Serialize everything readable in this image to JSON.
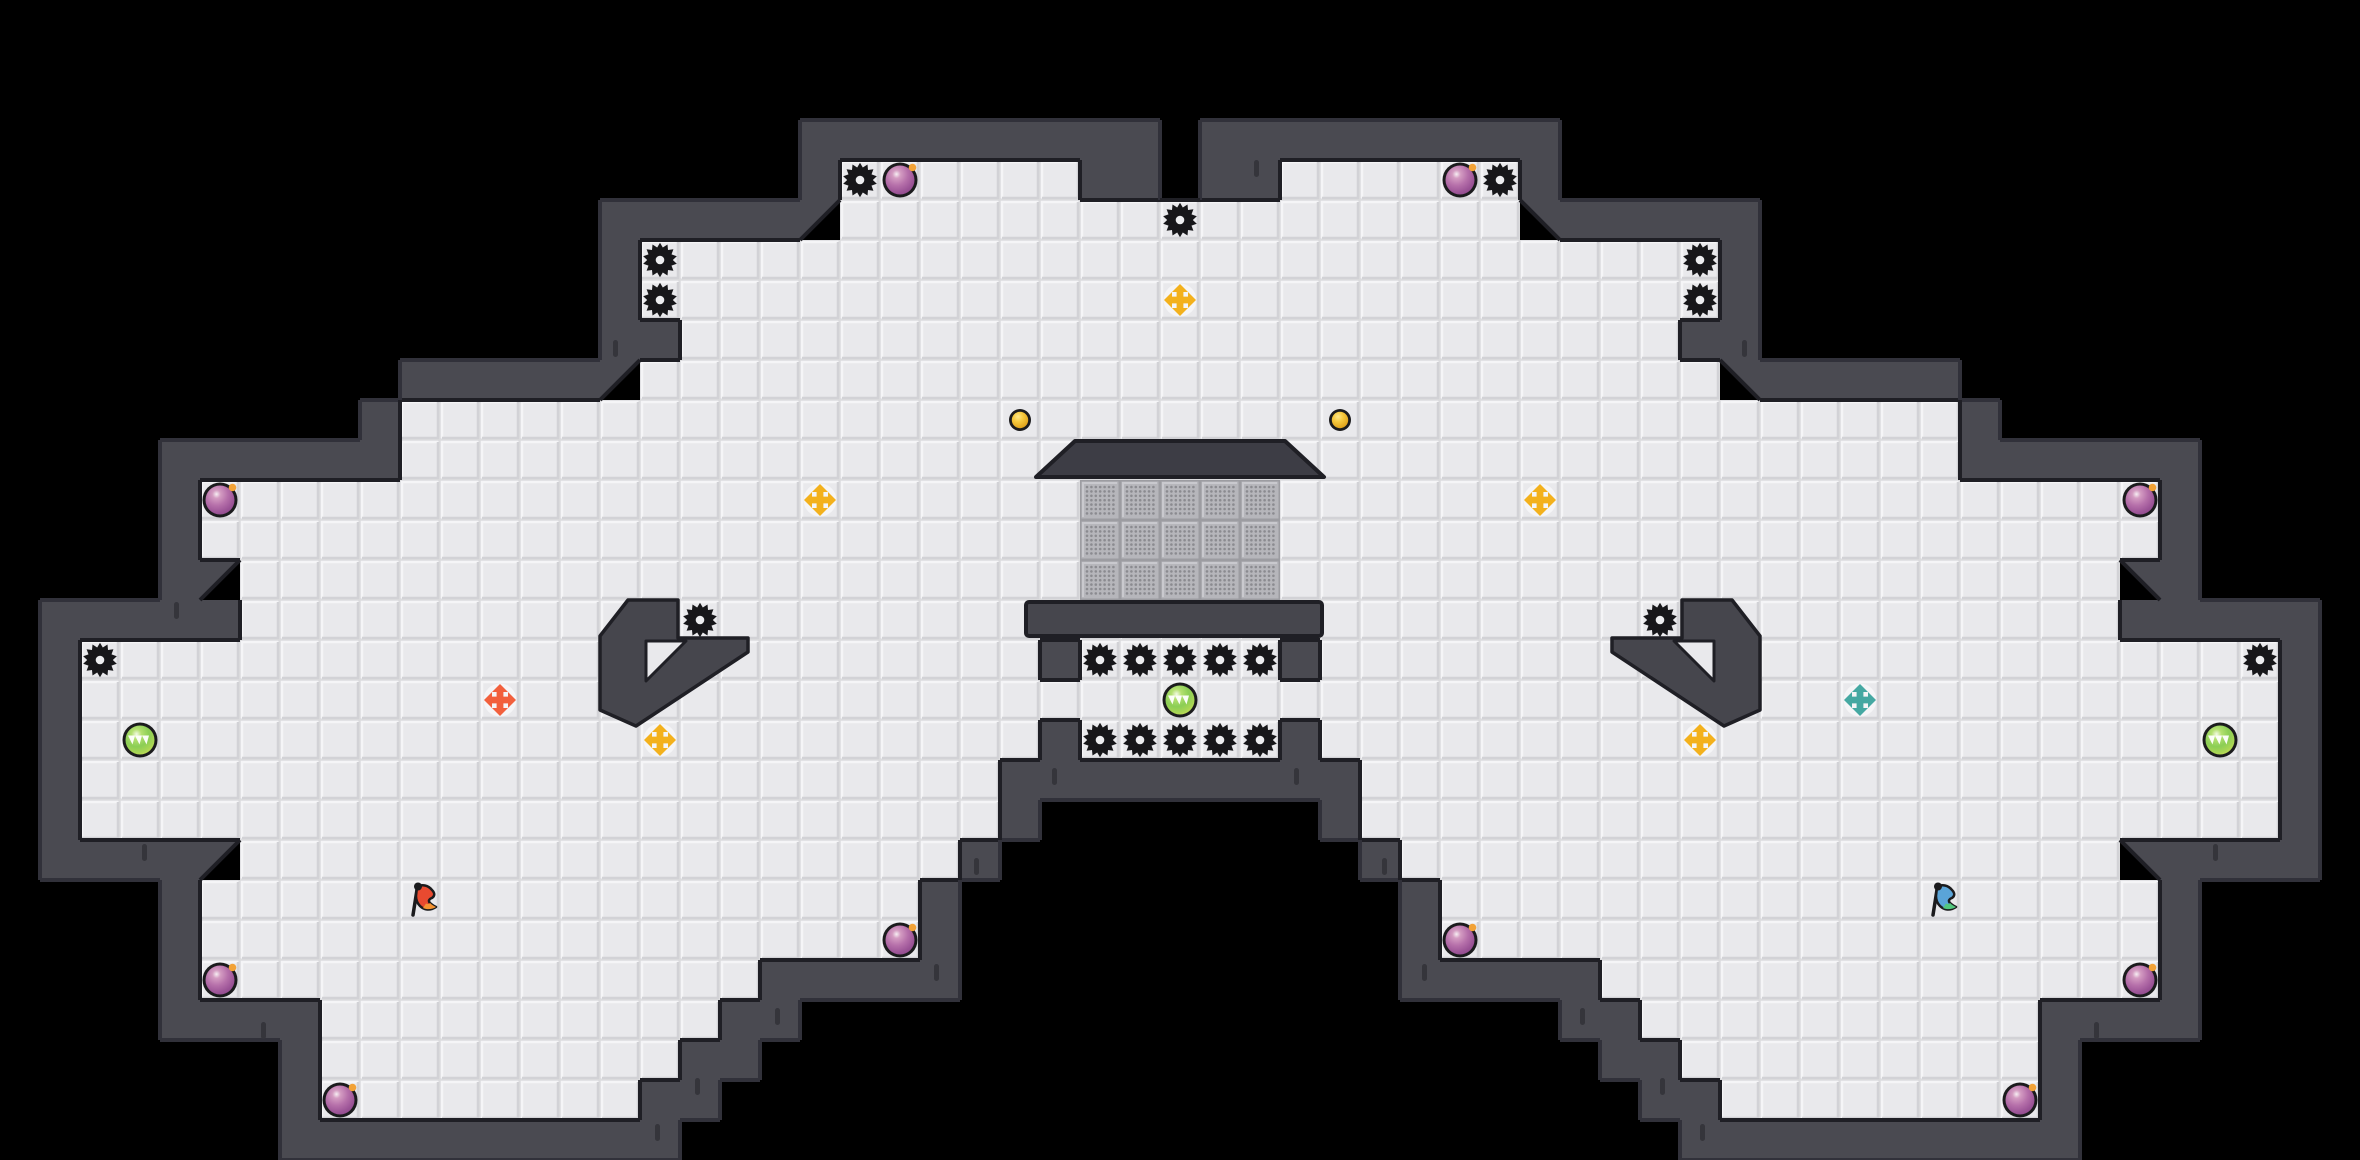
{
  "meta": {
    "app": "tagpro-style-ctf-map",
    "tile_size": 40,
    "cols": 59,
    "rows": 29,
    "width": 2360,
    "height": 1160
  },
  "palette": {
    "background": "#000000",
    "wall": "#4a4a51",
    "wall_edge_inner": "#1f1f25",
    "wall_edge_outer": "#31313a",
    "wall_crack": "#35353b",
    "floor": "#e9e9ec",
    "floor_gap": "#dcdcdf",
    "floor_hl": "#f5f5f7",
    "floor_sh": "#d2d2d6",
    "gate_base": "#b6b6bb",
    "gate_border": "#9c9ca1",
    "gate_dot": "#8b8b90",
    "gate_hl": "#c9c9ce",
    "spike": "#17171a",
    "spike_hole": "#edeef0",
    "bomb_outline": "#1b1b1d",
    "bomb_hl": "#f7eff3",
    "bomb_mid": "#b670aa",
    "bomb_dark": "#8f4a8c",
    "bomb_fuse": "#f2a236",
    "button_hl": "#ffe88a",
    "button_mid": "#f6c93e",
    "button_dark": "#dc9c15",
    "boost_pad": "#f5f5f7",
    "boost_yellow": "#f3b11d",
    "boost_red": "#f2603d",
    "boost_blue": "#45a8a2",
    "powerup_hl": "#f4fae6",
    "powerup_mid": "#8bce55",
    "powerup_edge": "#c6df56",
    "powerup_chevron": "#ffffff",
    "flag_red": "#e84a30",
    "flag_red_tip": "#f59331",
    "flag_blue": "#5aa4d8",
    "flag_blue_tip": "#52c77e",
    "structure": "#3d3d45",
    "platform": "#46464d"
  },
  "map": {
    "legend": {
      "#": "wall",
      ".": "floor",
      "G": "gate",
      "1": "wall-diagonal-upper-left",
      "2": "wall-diagonal-upper-right",
      " ": "outside"
    },
    "grid_runs": {
      "3": [
        [
          20,
          "#########"
        ],
        [
          30,
          "#########"
        ]
      ],
      "4": [
        [
          20,
          "#......##"
        ],
        [
          30,
          "##......#"
        ]
      ],
      "5": [
        [
          15,
          "#####1.................2#####"
        ]
      ],
      "6": [
        [
          15,
          "#...........................#"
        ]
      ],
      "7": [
        [
          15,
          "#...........................#"
        ]
      ],
      "8": [
        [
          15,
          "##.........................##"
        ]
      ],
      "9": [
        [
          10,
          "#####1...........................2#####"
        ]
      ],
      "10": [
        [
          9,
          "#.......................................#"
        ]
      ],
      "11": [
        [
          4,
          "######.......................................######"
        ]
      ],
      "12": [
        [
          4,
          "#......................GGGGG......................#"
        ]
      ],
      "13": [
        [
          4,
          "#......................GGGGG......................#"
        ]
      ],
      "14": [
        [
          4,
          "#1.....................GGGGG.....................2#"
        ]
      ],
      "15": [
        [
          1,
          "#####...............................................#####"
        ]
      ],
      "16": [
        [
          1,
          "#........................#.....#........................#"
        ]
      ],
      "17": [
        [
          1,
          "#.......................................................#"
        ]
      ],
      "18": [
        [
          1,
          "#........................#.....#........................#"
        ]
      ],
      "19": [
        [
          1,
          "#.......................#########.......................#"
        ]
      ],
      "20": [
        [
          1,
          "#.......................#       #.......................#"
        ]
      ],
      "21": [
        [
          1,
          "####1..................#         #..................2####"
        ]
      ],
      "22": [
        [
          4,
          "#..................#           #..................#"
        ]
      ],
      "23": [
        [
          4,
          "#..................#           #..................#"
        ]
      ],
      "24": [
        [
          4,
          "#..............#####           #####..............#"
        ]
      ],
      "25": [
        [
          4,
          "####..........##                   ##..........####"
        ]
      ],
      "26": [
        [
          7,
          "#.........##                     ##.........#"
        ]
      ],
      "27": [
        [
          7,
          "#........##                       ##........#"
        ]
      ],
      "28": [
        [
          7,
          "##########"
        ],
        [
          42,
          "##########"
        ]
      ]
    }
  },
  "entities": {
    "spikes": [
      [
        21,
        4
      ],
      [
        37,
        4
      ],
      [
        29,
        5
      ],
      [
        16,
        6
      ],
      [
        16,
        7
      ],
      [
        42,
        6
      ],
      [
        42,
        7
      ],
      [
        17,
        15
      ],
      [
        41,
        15
      ],
      [
        2,
        16
      ],
      [
        56,
        16
      ],
      [
        27,
        16
      ],
      [
        28,
        16
      ],
      [
        29,
        16
      ],
      [
        30,
        16
      ],
      [
        31,
        16
      ],
      [
        27,
        18
      ],
      [
        28,
        18
      ],
      [
        29,
        18
      ],
      [
        30,
        18
      ],
      [
        31,
        18
      ]
    ],
    "bombs": [
      [
        22,
        4
      ],
      [
        36,
        4
      ],
      [
        5,
        12
      ],
      [
        53,
        12
      ],
      [
        22,
        23
      ],
      [
        36,
        23
      ],
      [
        5,
        24
      ],
      [
        53,
        24
      ],
      [
        8,
        27
      ],
      [
        50,
        27
      ]
    ],
    "buttons": [
      [
        25,
        10
      ],
      [
        33,
        10
      ]
    ],
    "boosts": [
      {
        "c": 29,
        "r": 7,
        "team": "yellow"
      },
      {
        "c": 20,
        "r": 12,
        "team": "yellow"
      },
      {
        "c": 38,
        "r": 12,
        "team": "yellow"
      },
      {
        "c": 16,
        "r": 18,
        "team": "yellow"
      },
      {
        "c": 42,
        "r": 18,
        "team": "yellow"
      },
      {
        "c": 12,
        "r": 17,
        "team": "red"
      },
      {
        "c": 46,
        "r": 17,
        "team": "blue"
      }
    ],
    "powerups": [
      [
        3,
        18
      ],
      [
        29,
        17
      ],
      [
        55,
        18
      ]
    ],
    "flags": [
      {
        "c": 10,
        "r": 22,
        "team": "red"
      },
      {
        "c": 48,
        "r": 22,
        "team": "blue"
      }
    ]
  },
  "structures": {
    "roof": {
      "points": [
        [
          1036,
          477
        ],
        [
          1075,
          441
        ],
        [
          1285,
          441
        ],
        [
          1324,
          477
        ]
      ]
    },
    "platform": {
      "x": 1026,
      "y": 602,
      "w": 296,
      "h": 34
    },
    "hooks": [
      {
        "path": "M628,600 L678,600 L678,638 L748,638 L748,652 L636,726 L600,710 L600,636 Z",
        "notch": "M646,641 L686,641 L646,681 Z"
      },
      {
        "path": "M1732,600 L1682,600 L1682,638 L1612,638 L1612,652 L1724,726 L1760,710 L1760,636 Z",
        "notch": "M1714,641 L1674,641 L1714,681 Z"
      }
    ]
  },
  "decor": {
    "cracks": [
      [
        174,
        602
      ],
      [
        1254,
        160
      ],
      [
        613,
        340
      ],
      [
        1742,
        340
      ],
      [
        1052,
        768
      ],
      [
        1294,
        768
      ],
      [
        974,
        858
      ],
      [
        1382,
        858
      ],
      [
        934,
        964
      ],
      [
        1422,
        964
      ],
      [
        142,
        844
      ],
      [
        2213,
        844
      ],
      [
        261,
        1022
      ],
      [
        2094,
        1022
      ],
      [
        775,
        1008
      ],
      [
        1580,
        1008
      ],
      [
        695,
        1078
      ],
      [
        1660,
        1078
      ],
      [
        655,
        1124
      ],
      [
        1700,
        1124
      ]
    ],
    "crack_size": {
      "w": 5,
      "h": 17
    }
  }
}
